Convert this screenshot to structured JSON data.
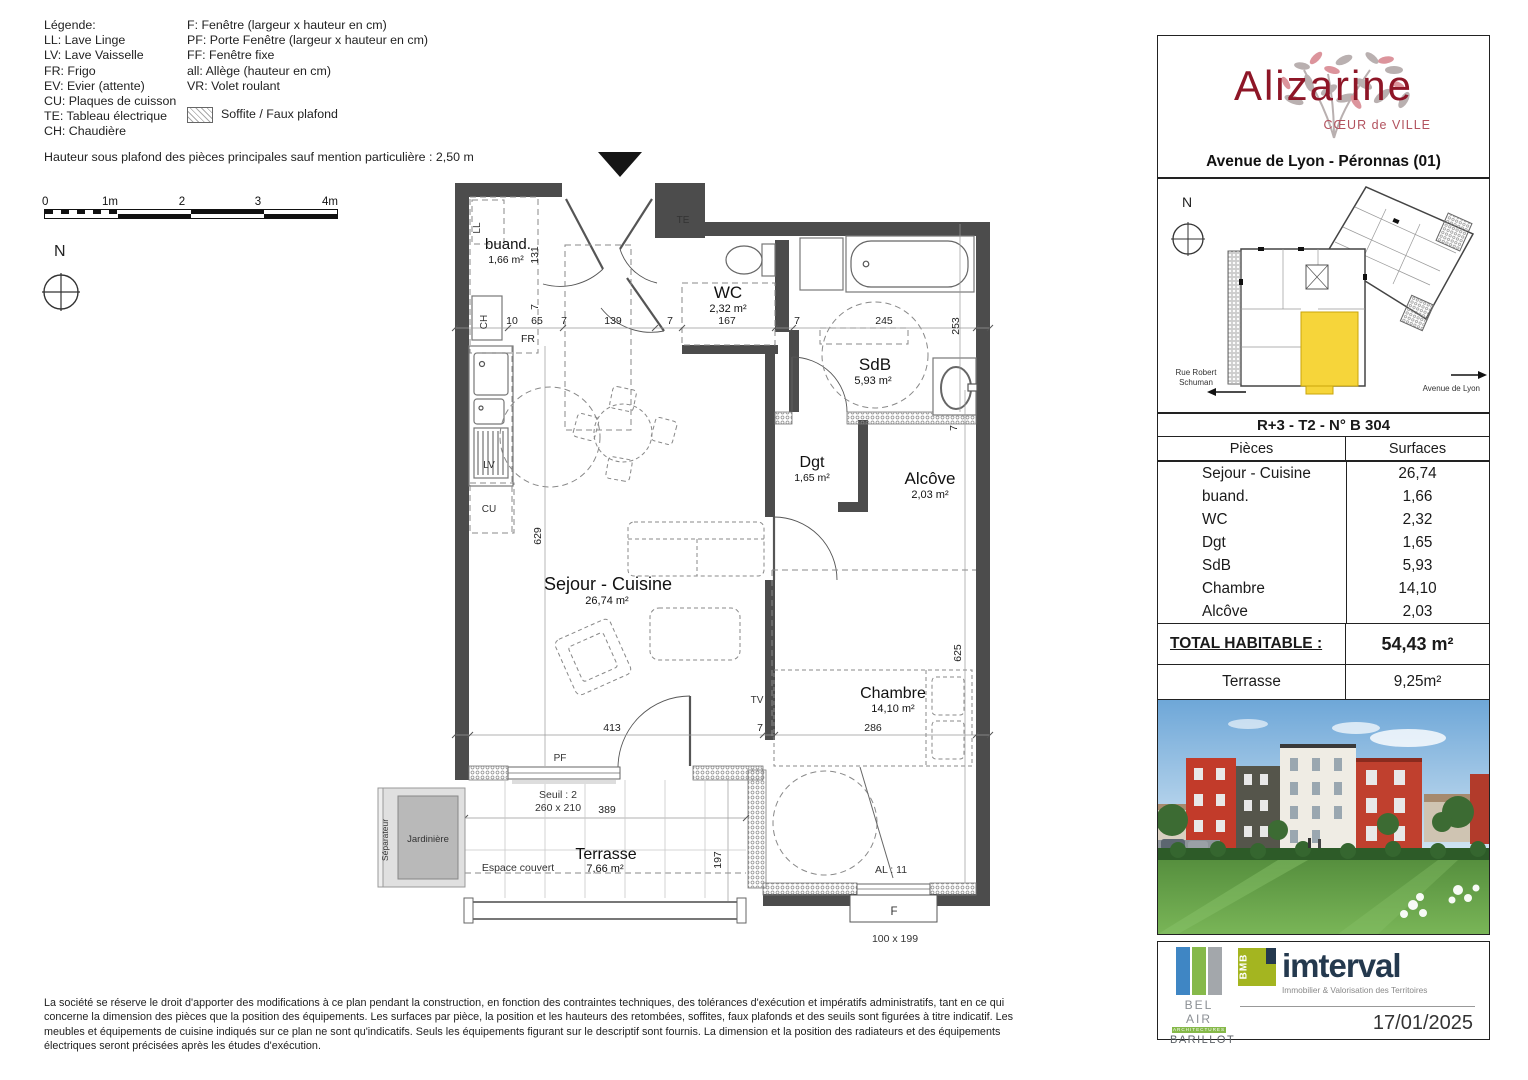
{
  "legend": {
    "title": "Légende:",
    "left": [
      "LL: Lave Linge",
      "LV: Lave Vaisselle",
      "FR: Frigo",
      "EV: Evier (attente)",
      "CU: Plaques de cuisson",
      "TE: Tableau électrique",
      "CH: Chaudière"
    ],
    "right": [
      "F: Fenêtre (largeur x hauteur en cm)",
      "PF: Porte Fenêtre (largeur x hauteur en cm)",
      "FF: Fenêtre fixe",
      "all: Allège (hauteur en cm)",
      "VR: Volet roulant"
    ],
    "soffite": "Soffite / Faux plafond",
    "note": "Hauteur sous plafond des pièces principales sauf mention particulière : 2,50 m"
  },
  "scale_bar": {
    "ticks": [
      "0",
      "1m",
      "2",
      "3",
      "4m"
    ]
  },
  "compass": {
    "label": "N"
  },
  "plan": {
    "rooms": {
      "buand": {
        "name": "buand.",
        "area": "1,66 m²"
      },
      "wc": {
        "name": "WC",
        "area": "2,32 m²"
      },
      "sdb": {
        "name": "SdB",
        "area": "5,93 m²"
      },
      "dgt": {
        "name": "Dgt",
        "area": "1,65 m²"
      },
      "alcove": {
        "name": "Alcôve",
        "area": "2,03 m²"
      },
      "sejour": {
        "name": "Sejour - Cuisine",
        "area": "26,74 m²"
      },
      "chambre": {
        "name": "Chambre",
        "area": "14,10 m²"
      },
      "terrasse": {
        "name": "Terrasse",
        "area": "7,66 m²"
      }
    },
    "equipment": {
      "ll": "LL",
      "ch": "CH",
      "fr": "FR",
      "lv": "LV",
      "cu": "CU",
      "te": "TE",
      "tv": "TV",
      "pf": "PF"
    },
    "annotations": {
      "seuil": "Seuil : 2",
      "seuil_size": "260 x 210",
      "espace_couvert": "Espace couvert",
      "jardiniere": "Jardinière",
      "separateur": "Séparateur",
      "al": "AL : 11",
      "window_label": "F",
      "window_size": "100 x 199"
    },
    "dims": {
      "top": [
        "10",
        "65",
        "7",
        "139",
        "7",
        "167",
        "7",
        "245"
      ],
      "v_131": "131",
      "v_7a": "7",
      "v_253": "253",
      "v_629": "629",
      "v_7b": "7",
      "bottom": [
        "413",
        "7",
        "286"
      ],
      "v_625": "625",
      "v_197": "197",
      "h_389": "389"
    }
  },
  "panel": {
    "logo": {
      "title": "Alizarine",
      "subtitle": "CŒUR de VILLE",
      "address": "Avenue de Lyon - Péronnas (01)"
    },
    "site": {
      "north": "N",
      "street_left_1": "Rue Robert",
      "street_left_2": "Schuman",
      "street_right": "Avenue de Lyon"
    },
    "unit": {
      "title": "R+3 - T2 - N° B 304",
      "col_pieces": "Pièces",
      "col_surfaces": "Surfaces",
      "rows": [
        {
          "piece": "Sejour - Cuisine",
          "surface": "26,74"
        },
        {
          "piece": "buand.",
          "surface": "1,66"
        },
        {
          "piece": "WC",
          "surface": "2,32"
        },
        {
          "piece": "Dgt",
          "surface": "1,65"
        },
        {
          "piece": "SdB",
          "surface": "5,93"
        },
        {
          "piece": "Chambre",
          "surface": "14,10"
        },
        {
          "piece": "Alcôve",
          "surface": "2,03"
        }
      ],
      "total_label": "TOTAL HABITABLE :",
      "total_value": "54,43 m²",
      "terrasse_label": "Terrasse",
      "terrasse_value": "9,25m²"
    },
    "branding": {
      "belair": {
        "name": "BEL AIR",
        "line2": "ARCHITECTURES",
        "line3": "BARILLOT"
      },
      "imterval": {
        "bmb": "BMB",
        "name": "imterval",
        "subtitle": "Immobilier & Valorisation des Territoires"
      },
      "date": "17/01/2025"
    }
  },
  "footer": {
    "disclaimer": "La société se réserve le droit d'apporter des modifications à ce plan pendant la construction, en fonction des contraintes techniques, des tolérances d'exécution et impératifs administratifs, tant en ce qui concerne la dimension des pièces que la position des équipements. Les surfaces par pièce, la position et les hauteurs des retombées,  soffites, faux plafonds et des seuils sont figurées à titre indicatif. Les meubles et équipements de cuisine indiqués sur ce plan ne sont qu'indicatifs. Seuls les équipements figurant sur le descriptif sont fournis. La dimension et la position des radiateurs et des équipements électriques seront précisées après les études d'exécution."
  },
  "colors": {
    "alizarine_red": "#8e1627",
    "unit_highlight": "#f6d53a",
    "wall": "#4c4c4c",
    "imterval_navy": "#24394e",
    "imterval_green": "#a4b520",
    "belair_blue": "#3f86c4",
    "belair_green": "#86b94a"
  }
}
